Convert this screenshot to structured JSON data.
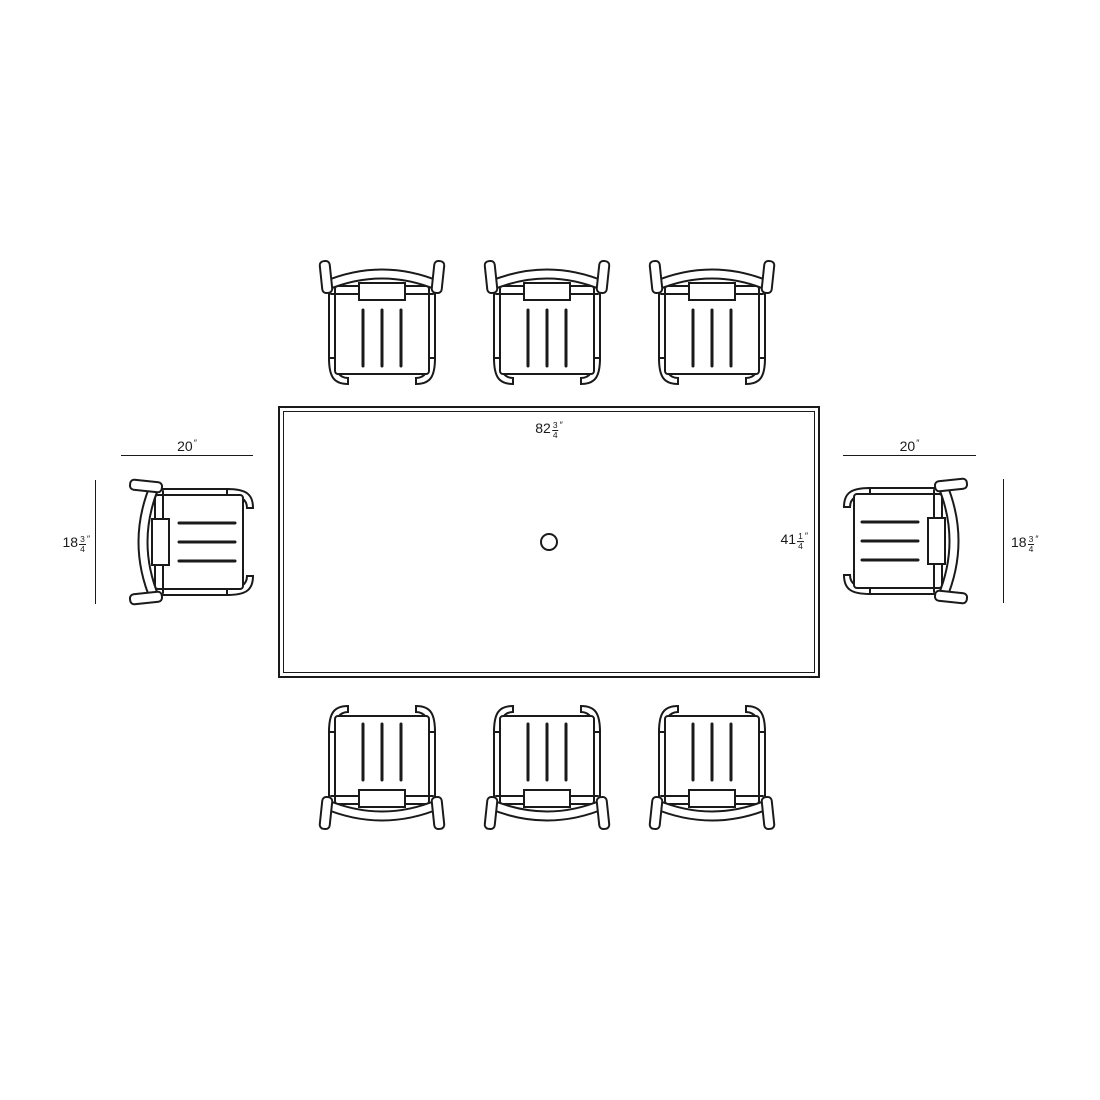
{
  "diagram": {
    "type": "outdoor-dining-set-top-view-dimensions",
    "background": "#ffffff",
    "line_color": "#1a1a1a",
    "table": {
      "length_label": {
        "whole": "82",
        "frac_num": "3",
        "frac_den": "4",
        "unit": "″"
      },
      "width_label": {
        "whole": "41",
        "frac_num": "1",
        "frac_den": "4",
        "unit": "″"
      }
    },
    "chairs": {
      "count": 8,
      "width_label_left": {
        "whole": "20",
        "unit": "″"
      },
      "width_label_right": {
        "whole": "20",
        "unit": "″"
      },
      "depth_label_left": {
        "whole": "18",
        "frac_num": "3",
        "frac_den": "4",
        "unit": "″"
      },
      "depth_label_right": {
        "whole": "18",
        "frac_num": "3",
        "frac_den": "4",
        "unit": "″"
      }
    }
  }
}
